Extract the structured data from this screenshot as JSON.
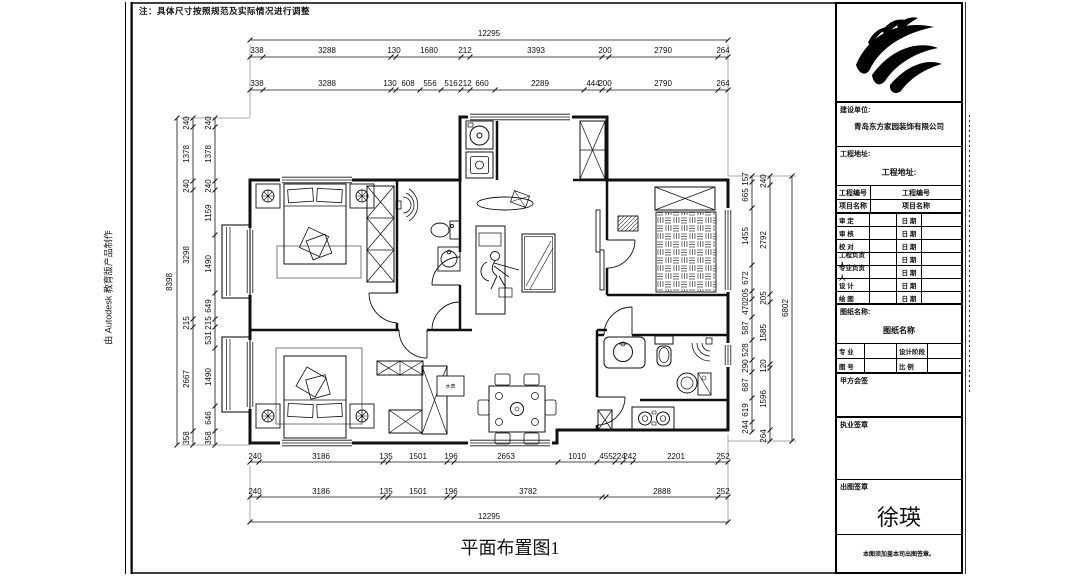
{
  "sheet": {
    "note": "注：具体尺寸按照规范及实际情况进行调整",
    "autodesk_strip": "由 Autodesk 教育版产品制作",
    "drawing_title": "平面布置图1"
  },
  "title_block": {
    "logo_icon": "claw-feather-logo",
    "construction_unit_label": "建设单位:",
    "construction_unit": "青岛东方家园装饰有限公司",
    "project_address_label": "工程地址:",
    "project_address": "工程地址:",
    "project_no_label": "工程编号",
    "project_no": "工程编号",
    "project_name_label": "项目名称",
    "project_name": "项目名称",
    "rows": [
      {
        "label": "审  定",
        "date_label": "日 期"
      },
      {
        "label": "审  核",
        "date_label": "日 期"
      },
      {
        "label": "校  对",
        "date_label": "日 期"
      },
      {
        "label": "工程负责人",
        "date_label": "日 期"
      },
      {
        "label": "专业负责人",
        "date_label": "日 期"
      },
      {
        "label": "设  计",
        "date_label": "日 期"
      },
      {
        "label": "绘  图",
        "date_label": "日 期"
      }
    ],
    "drawing_name_label": "图纸名称:",
    "drawing_name": "图纸名称",
    "specialty_label": "专  业",
    "design_stage_label": "设计阶段",
    "drawing_no_label": "图  号",
    "scale_label": "比  例",
    "client_sign_label": "甲方会签",
    "practice_seal_label": "执业签章",
    "issue_seal_label": "出图签章",
    "signature": "徐瑛",
    "bottom_note": "本图须加盖本司出图签章。"
  },
  "plan": {
    "labels": {
      "water_meter": "水表"
    },
    "dims": {
      "top_overall": "12295",
      "top_row1": [
        "338",
        "3288",
        "130",
        "1680",
        "212",
        "3393",
        "200",
        "2790",
        "264"
      ],
      "top_row2": [
        "338",
        "3288",
        "130",
        "608",
        "556",
        "516",
        "212",
        "660",
        "2289",
        "444",
        "200",
        "2790",
        "264"
      ],
      "bottom_row1": [
        "240",
        "3186",
        "135",
        "1501",
        "196",
        "2653",
        "1010",
        "455",
        "224",
        "242",
        "2201",
        "252"
      ],
      "bottom_row2": [
        "240",
        "3186",
        "135",
        "1501",
        "196",
        "3782",
        "2888",
        "252"
      ],
      "bottom_overall": "12295",
      "left_overall": "8398",
      "left_outer": [
        "240",
        "1378",
        "240",
        "3298",
        "215",
        "2667",
        "358"
      ],
      "left_inner": [
        "240",
        "1378",
        "240",
        "1159",
        "1490",
        "649",
        "215",
        "531",
        "1490",
        "646",
        "358"
      ],
      "right_inner": [
        "157",
        "665",
        "1455",
        "672",
        "205",
        "470",
        "587",
        "528",
        "290",
        "687",
        "619",
        "244"
      ],
      "right_outer": [
        "240",
        "2792",
        "205",
        "1585",
        "120",
        "1596",
        "264"
      ],
      "right_overall": "6802"
    }
  }
}
